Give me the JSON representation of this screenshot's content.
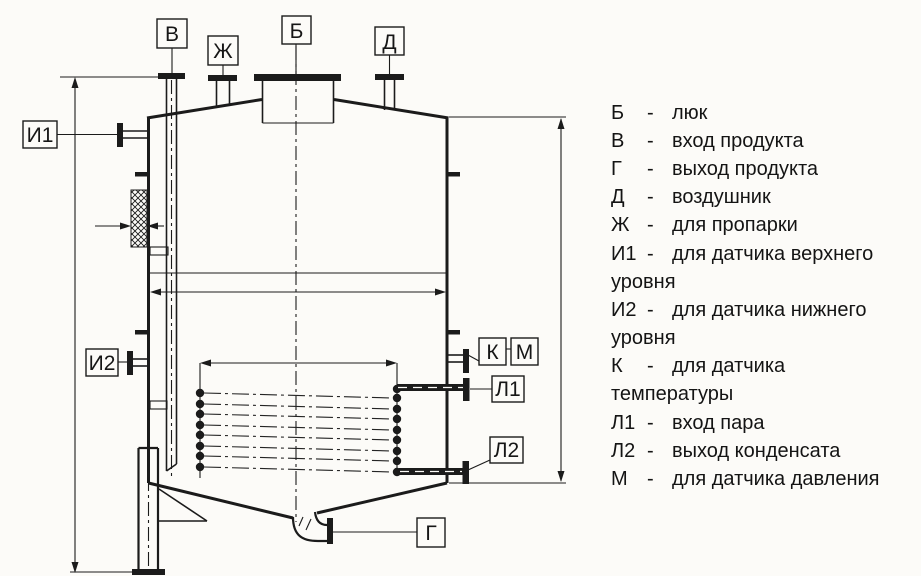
{
  "canvas": {
    "bg": "#fcfbf8",
    "ink": "#1b1b1b"
  },
  "diagram": {
    "labels": {
      "b": "Б",
      "v": "В",
      "g": "Г",
      "d": "Д",
      "zh": "Ж",
      "i1": "И1",
      "i2": "И2",
      "k": "К",
      "m": "М",
      "l1": "Л1",
      "l2": "Л2"
    }
  },
  "legend": {
    "rows": [
      {
        "letter": "Б",
        "dash": "-",
        "text": "люк"
      },
      {
        "letter": "В",
        "dash": "-",
        "text": "вход продукта"
      },
      {
        "letter": "Г",
        "dash": "-",
        "text": "выход продукта"
      },
      {
        "letter": "Д",
        "dash": "-",
        "text": "воздушник"
      },
      {
        "letter": "Ж",
        "dash": "-",
        "text": "для пропарки"
      },
      {
        "letter": "И1",
        "dash": "-",
        "text": "для датчика верхнего"
      },
      {
        "letter": "",
        "dash": "",
        "text": "уровня"
      },
      {
        "letter": "И2",
        "dash": "-",
        "text": "для датчика нижнего"
      },
      {
        "letter": "",
        "dash": "",
        "text": "уровня"
      },
      {
        "letter": "К",
        "dash": "-",
        "text": "для датчика"
      },
      {
        "letter": "",
        "dash": "",
        "text": "температуры"
      },
      {
        "letter": "Л1",
        "dash": "-",
        "text": "вход пара"
      },
      {
        "letter": "Л2",
        "dash": "-",
        "text": "выход конденсата"
      },
      {
        "letter": "М",
        "dash": "-",
        "text": "для датчика давления"
      }
    ]
  }
}
